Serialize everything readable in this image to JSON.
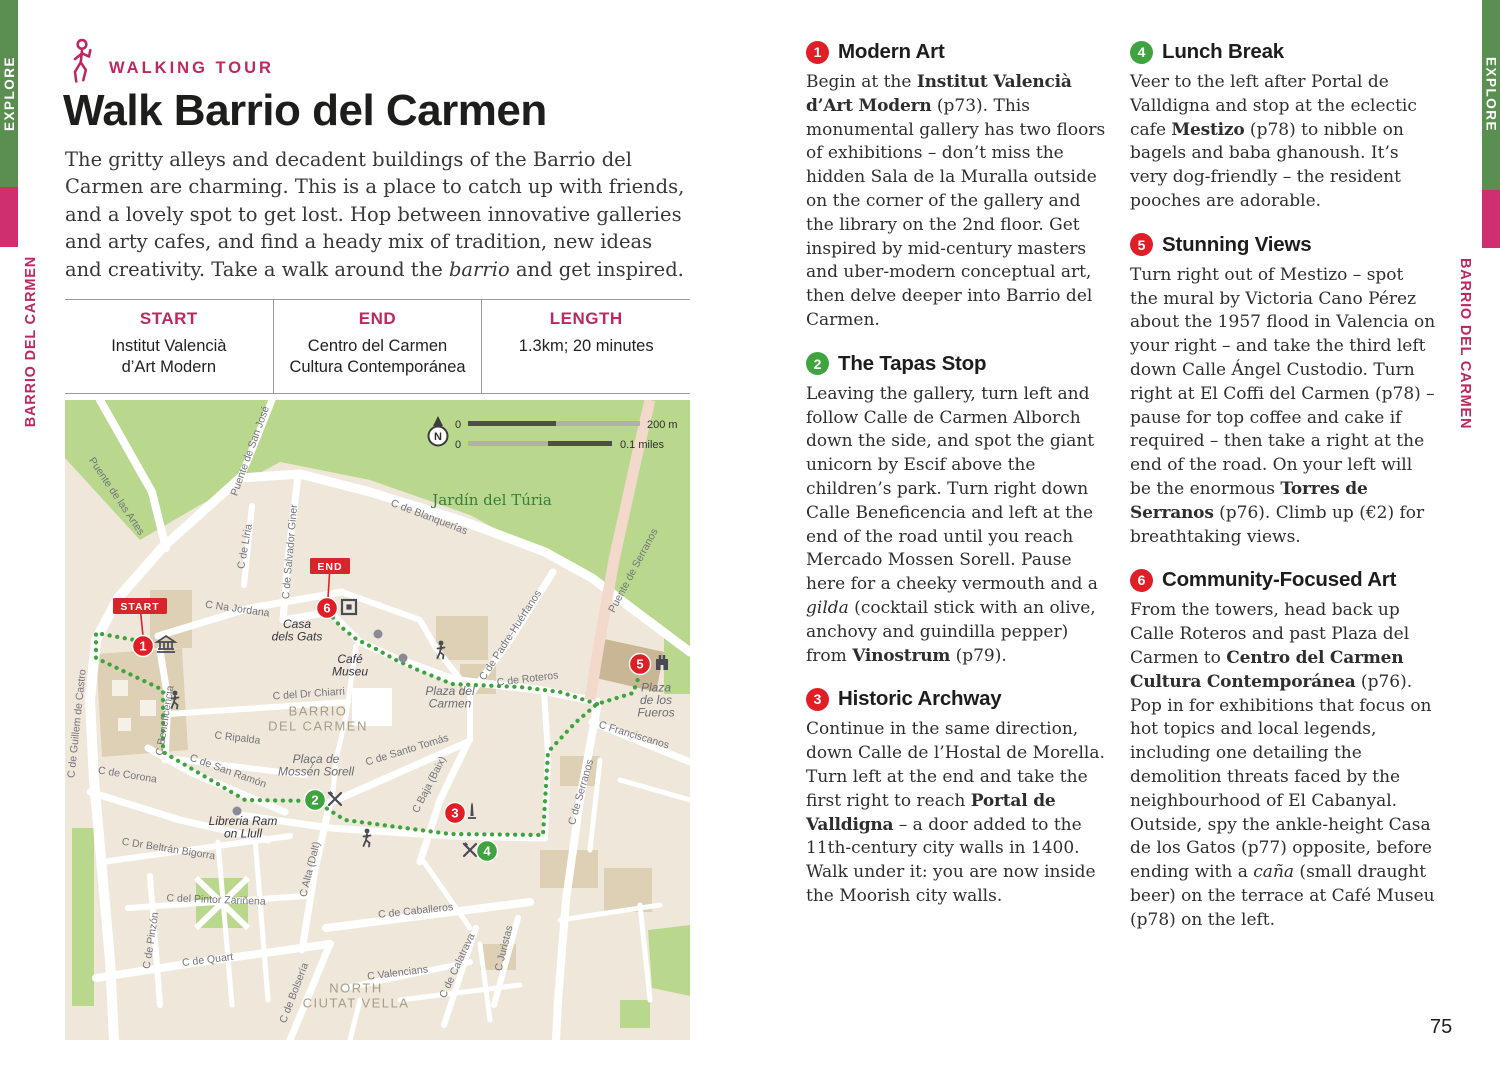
{
  "page": {
    "left_number": "74",
    "right_number": "75"
  },
  "sidebar": {
    "explore": "EXPLORE",
    "section": "BARRIO DEL CARMEN"
  },
  "colors": {
    "accent_pink": "#bd2860",
    "bar_green": "#5b8f51",
    "bar_pink": "#cf2f6e",
    "pin_red": "#e01e26",
    "pin_green": "#3fa43f",
    "park_green": "#b9d88e"
  },
  "header": {
    "eyebrow": "WALKING TOUR",
    "title": "Walk Barrio del Carmen"
  },
  "intro": [
    {
      "t": "The gritty alleys and decadent buildings of the Barrio del Carmen are charming. This is a place to catch up with friends, and a lovely spot to get lost. Hop between innovative galleries and arty cafes, and find a heady mix of tradition, new ideas and creativity. Take a walk around the "
    },
    {
      "i": "barrio"
    },
    {
      "t": " and get inspired."
    }
  ],
  "info_table": {
    "cols": [
      {
        "header": "START",
        "lines": [
          "Institut Valencià",
          "d’Art Modern"
        ]
      },
      {
        "header": "END",
        "lines": [
          "Centro del Carmen",
          "Cultura Contemporánea"
        ]
      },
      {
        "header": "LENGTH",
        "lines": [
          "1.3km; 20 minutes",
          ""
        ]
      }
    ]
  },
  "stops": [
    {
      "num": "1",
      "title": "Modern Art",
      "color": "#e01e26",
      "body": [
        {
          "t": "Begin at the "
        },
        {
          "b": "Institut Valencià d’Art Modern"
        },
        {
          "t": " (p73). This monumental gallery has two floors of exhibitions – don’t miss the hidden Sala de la Muralla outside on the corner of the gallery and the library on the 2nd floor. Get inspired by mid-century masters and uber-modern conceptual art, then delve deeper into Barrio del Carmen."
        }
      ]
    },
    {
      "num": "2",
      "title": "The Tapas Stop",
      "color": "#3fa43f",
      "body": [
        {
          "t": "Leaving the gallery, turn left and follow Calle de Carmen Alborch down the side, and spot the giant unicorn by Escif above the children’s park. Turn right down Calle Beneficencia and left at the end of the road until you reach Mercado Mossen Sorell. Pause here for a cheeky vermouth and a "
        },
        {
          "i": "gilda"
        },
        {
          "t": " (cocktail stick with an olive, anchovy and guindilla pepper) from "
        },
        {
          "b": "Vinostrum"
        },
        {
          "t": " (p79)."
        }
      ]
    },
    {
      "num": "3",
      "title": "Historic Archway",
      "color": "#e01e26",
      "body": [
        {
          "t": "Continue in the same direction, down Calle de l’Hostal de Morella. Turn left at the end and take the first right to reach "
        },
        {
          "b": "Portal de Valldigna"
        },
        {
          "t": " – a door added to the 11th-century city walls in 1400. Walk under it: you are now inside the Moorish city walls."
        }
      ]
    },
    {
      "num": "4",
      "title": "Lunch Break",
      "color": "#3fa43f",
      "body": [
        {
          "t": "Veer to the left after Portal de Valldigna and stop at the eclectic cafe "
        },
        {
          "b": "Mestizo"
        },
        {
          "t": " (p78) to nibble on bagels and baba ghanoush. It’s very dog-friendly – the resident pooches are adorable."
        }
      ]
    },
    {
      "num": "5",
      "title": "Stunning Views",
      "color": "#e01e26",
      "body": [
        {
          "t": "Turn right out of Mestizo – spot the mural by Victoria Cano Pérez about the 1957 flood in Valencia on your right – and take the third left down Calle Ángel Custodio. Turn right at El Coffi del Carmen (p78) – pause for top coffee and cake if required – then take a right at the end of the road. On your left will be the enormous "
        },
        {
          "b": "Torres de Serranos"
        },
        {
          "t": " (p76). Climb up (€2) for breathtaking views."
        }
      ]
    },
    {
      "num": "6",
      "title": "Community-Focused Art",
      "color": "#e01e26",
      "body": [
        {
          "t": "From the towers, head back up Calle Roteros and past Plaza del Carmen to "
        },
        {
          "b": "Centro del Carmen Cultura Contemporánea"
        },
        {
          "t": " (p76). Pop in for exhibitions that focus on hot topics and local legends, including one detailing the demolition threats faced by the neighbourhood of El Cabanyal. Outside, spy the ankle-height Casa de los Gatos (p77) opposite, before ending with a "
        },
        {
          "i": "caña"
        },
        {
          "t": " (small draught beer) on the terrace at Café Museu (p78) on the left."
        }
      ]
    }
  ],
  "map": {
    "compass": "N",
    "scale": {
      "zero1": "0",
      "zero2": "0",
      "metric": "200 m",
      "imperial": "0.1 miles"
    },
    "labels": [
      {
        "text": [
          "Jardín del Túria"
        ],
        "x": 492,
        "y": 505,
        "rot": 0,
        "cls": "park"
      },
      {
        "text": [
          "Puente de las Artes"
        ],
        "x": 114,
        "y": 498,
        "rot": 56,
        "cls": "road"
      },
      {
        "text": [
          "Puente de San José"
        ],
        "x": 253,
        "y": 452,
        "rot": -70,
        "cls": "road"
      },
      {
        "text": [
          "C de Blanquerías"
        ],
        "x": 428,
        "y": 520,
        "rot": 21,
        "cls": "road"
      },
      {
        "text": [
          "C de Líria"
        ],
        "x": 248,
        "y": 547,
        "rot": -80,
        "cls": "road"
      },
      {
        "text": [
          "C de Salvador Giner"
        ],
        "x": 293,
        "y": 552,
        "rot": -85,
        "cls": "road"
      },
      {
        "text": [
          "Puente de Serranos"
        ],
        "x": 636,
        "y": 572,
        "rot": -62,
        "cls": "road"
      },
      {
        "text": [
          "C Na Jordana"
        ],
        "x": 237,
        "y": 612,
        "rot": 8,
        "cls": "road"
      },
      {
        "text": [
          "Casa",
          "dels Gats"
        ],
        "x": 297,
        "y": 634,
        "rot": 0,
        "cls": "poi"
      },
      {
        "text": [
          "Café",
          "Museu"
        ],
        "x": 350,
        "y": 669,
        "rot": 0,
        "cls": "poi"
      },
      {
        "text": [
          "Plaza del",
          "Carmen"
        ],
        "x": 450,
        "y": 701,
        "rot": 0,
        "cls": "poi2"
      },
      {
        "text": [
          "C de Roteros"
        ],
        "x": 528,
        "y": 682,
        "rot": -7,
        "cls": "road"
      },
      {
        "text": [
          "Plaza",
          "de los",
          "Fueros"
        ],
        "x": 656,
        "y": 704,
        "rot": 0,
        "cls": "poi2"
      },
      {
        "text": [
          "C Franciscanos"
        ],
        "x": 633,
        "y": 738,
        "rot": 17,
        "cls": "road"
      },
      {
        "text": [
          "C de Serranos"
        ],
        "x": 584,
        "y": 793,
        "rot": -74,
        "cls": "road"
      },
      {
        "text": [
          "C de Padre-Huérfanos"
        ],
        "x": 513,
        "y": 637,
        "rot": -57,
        "cls": "road"
      },
      {
        "text": [
          "C de Guillem de Castro"
        ],
        "x": 80,
        "y": 724,
        "rot": -84,
        "cls": "road"
      },
      {
        "text": [
          "C Beneficencia"
        ],
        "x": 168,
        "y": 721,
        "rot": -81,
        "cls": "road"
      },
      {
        "text": [
          "C del Dr Chiarri"
        ],
        "x": 309,
        "y": 697,
        "rot": -4,
        "cls": "road"
      },
      {
        "text": [
          "BARRIO",
          "DEL CARMEN"
        ],
        "x": 318,
        "y": 723,
        "rot": 0,
        "cls": "area"
      },
      {
        "text": [
          "C Ripalda"
        ],
        "x": 237,
        "y": 741,
        "rot": 7,
        "cls": "road"
      },
      {
        "text": [
          "Plaça de",
          "Mossén Sorell"
        ],
        "x": 316,
        "y": 769,
        "rot": 0,
        "cls": "poi2"
      },
      {
        "text": [
          "C de San Ramón"
        ],
        "x": 227,
        "y": 774,
        "rot": 20,
        "cls": "road"
      },
      {
        "text": [
          "C de Corona"
        ],
        "x": 127,
        "y": 778,
        "rot": 9,
        "cls": "road"
      },
      {
        "text": [
          "C de Santo Tomás"
        ],
        "x": 408,
        "y": 753,
        "rot": -17,
        "cls": "road"
      },
      {
        "text": [
          "C Baja (Baix)"
        ],
        "x": 432,
        "y": 786,
        "rot": -63,
        "cls": "road"
      },
      {
        "text": [
          "C Alta (Dalt)"
        ],
        "x": 313,
        "y": 870,
        "rot": -76,
        "cls": "road"
      },
      {
        "text": [
          "Libreria Ram",
          "on Llull"
        ],
        "x": 243,
        "y": 831,
        "rot": 0,
        "cls": "poi"
      },
      {
        "text": [
          "C Dr Beltrán Bigorra"
        ],
        "x": 168,
        "y": 852,
        "rot": 9,
        "cls": "road"
      },
      {
        "text": [
          "C del Pintor Zariñena"
        ],
        "x": 216,
        "y": 903,
        "rot": 2,
        "cls": "road"
      },
      {
        "text": [
          "C de Pinzón"
        ],
        "x": 154,
        "y": 941,
        "rot": -81,
        "cls": "road"
      },
      {
        "text": [
          "C de Quart"
        ],
        "x": 208,
        "y": 963,
        "rot": -7,
        "cls": "road"
      },
      {
        "text": [
          "C de Bolsería"
        ],
        "x": 297,
        "y": 994,
        "rot": -69,
        "cls": "road"
      },
      {
        "text": [
          "NORTH",
          "CIUTAT VELLA"
        ],
        "x": 356,
        "y": 1000,
        "rot": 0,
        "cls": "area"
      },
      {
        "text": [
          "C Valencians"
        ],
        "x": 398,
        "y": 976,
        "rot": -7,
        "cls": "road"
      },
      {
        "text": [
          "C de Caballeros"
        ],
        "x": 416,
        "y": 914,
        "rot": -6,
        "cls": "road"
      },
      {
        "text": [
          "C de Calatrava"
        ],
        "x": 460,
        "y": 967,
        "rot": -65,
        "cls": "road"
      },
      {
        "text": [
          "C Juristas"
        ],
        "x": 507,
        "y": 949,
        "rot": -76,
        "cls": "road"
      }
    ],
    "pins": [
      {
        "n": "1",
        "x": 143,
        "y": 646,
        "c": "#e01e26"
      },
      {
        "n": "2",
        "x": 315,
        "y": 800,
        "c": "#3fa43f"
      },
      {
        "n": "3",
        "x": 455,
        "y": 813,
        "c": "#e01e26"
      },
      {
        "n": "4",
        "x": 487,
        "y": 851,
        "c": "#3fa43f"
      },
      {
        "n": "5",
        "x": 640,
        "y": 664,
        "c": "#e01e26"
      },
      {
        "n": "6",
        "x": 327,
        "y": 608,
        "c": "#e01e26"
      }
    ],
    "badges": [
      {
        "text": "START",
        "x": 140,
        "y": 606,
        "w": 54,
        "tipx": 143,
        "tipy": 636
      },
      {
        "text": "END",
        "x": 330,
        "y": 566,
        "w": 40,
        "tipx": 328,
        "tipy": 598
      }
    ],
    "icons": [
      {
        "type": "museum",
        "x": 166,
        "y": 645
      },
      {
        "type": "gallery",
        "x": 349,
        "y": 607
      },
      {
        "type": "castle",
        "x": 662,
        "y": 663
      },
      {
        "type": "monument",
        "x": 472,
        "y": 811
      },
      {
        "type": "restaurant",
        "x": 335,
        "y": 799
      },
      {
        "type": "restaurant",
        "x": 470,
        "y": 850
      },
      {
        "type": "walker",
        "x": 175,
        "y": 700
      },
      {
        "type": "walker",
        "x": 441,
        "y": 650
      },
      {
        "type": "walker",
        "x": 367,
        "y": 838
      }
    ],
    "dots": [
      {
        "x": 378,
        "y": 634
      },
      {
        "x": 403,
        "y": 658
      },
      {
        "x": 237,
        "y": 811
      }
    ]
  }
}
